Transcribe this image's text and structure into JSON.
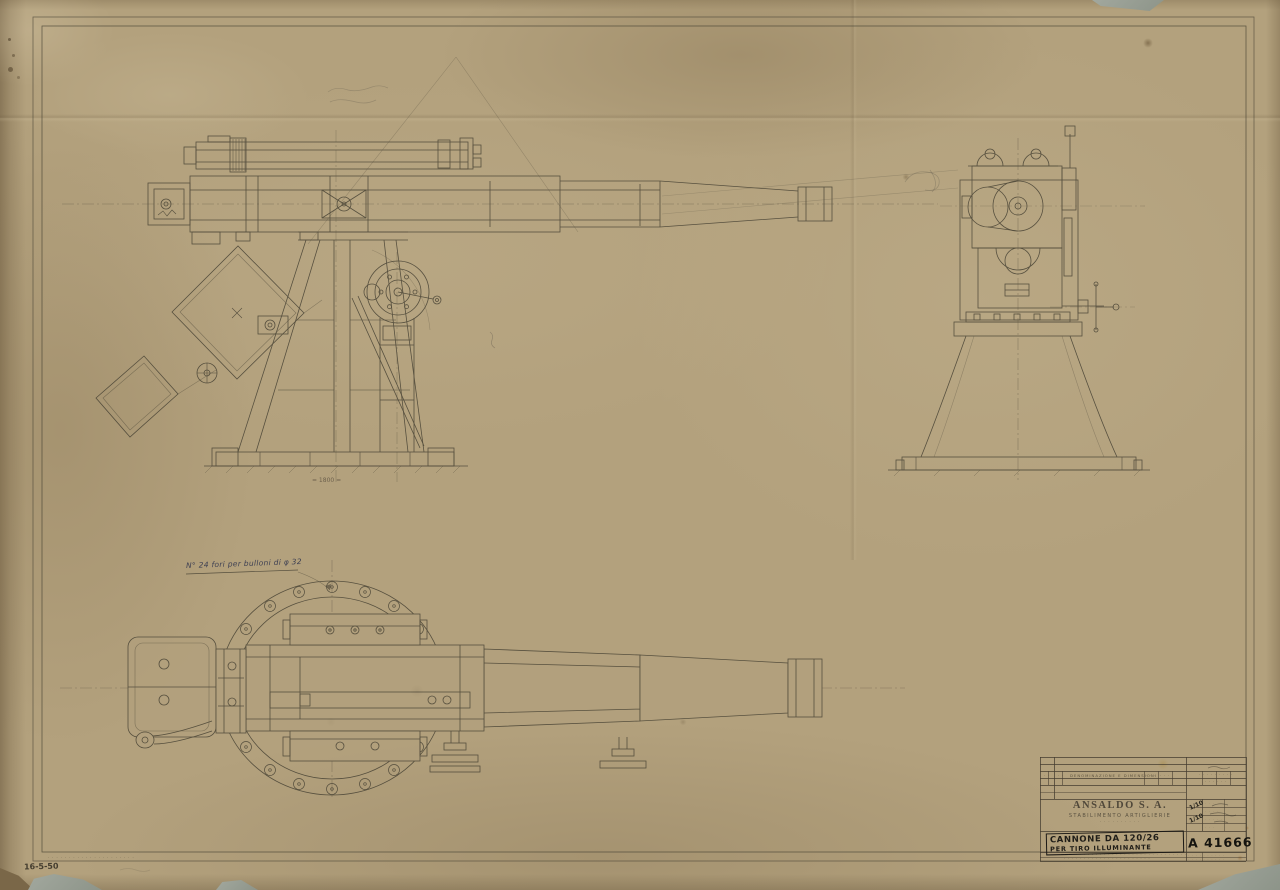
{
  "page": {
    "paper_color": "#b3a17d",
    "ink_color": "#474234"
  },
  "annotations": {
    "plan_note": "N° 24 fori per bulloni di φ 32",
    "pencil_dim": "= 1800 =",
    "bottom_left_date": "16-5-50",
    "bottom_left_print": "· · · · · ·  · ·  · ·  · · · ·  · · · ·  · · ·"
  },
  "title_block": {
    "company": "ANSALDO S. A.",
    "division": "STABILIMENTO ARTIGLIERIE",
    "division_sub": "· · · · · · · · · ·",
    "header": {
      "c1": "· ·",
      "c2": "· ·",
      "main": "DENOMINAZIONE E DIMENSIONI",
      "c4": "· · ·",
      "c5": "· · ·",
      "row_right_top": "· · ·   · · ·   · · ·",
      "row_right_bottom": "· ·   · ·   · ·"
    },
    "scale_top": "1/10",
    "scale_bottom": "1/10",
    "side_rows": [
      "· · ·",
      "· · · ·",
      "· · · · ·",
      "· · ·"
    ],
    "title_line1": "CANNONE DA 120/26",
    "title_line2": "PER TIRO ILLUMINANTE",
    "drawing_number": "A 41666",
    "micro_line1": "· · · · · · · · · · · · · · · · · · · · · · · · · · · · · · · ·",
    "micro_line2": "· · · · · · · · · · · · · · · · · · · · · ·",
    "sub_row1": "· · · · · · · · · ·",
    "sub_row2": "· · · · · · · · · ·"
  }
}
